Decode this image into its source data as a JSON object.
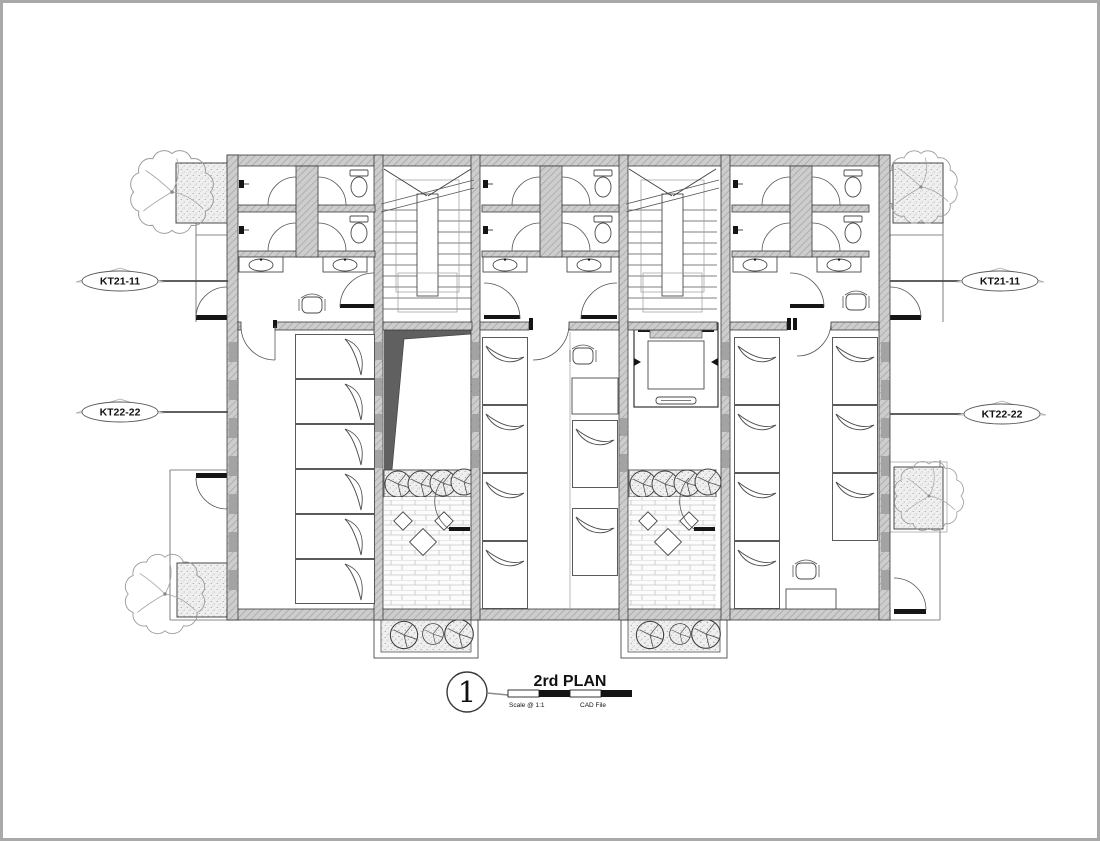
{
  "title_block": {
    "detail_number": "1",
    "title": "2rd PLAN",
    "scale_text": "Scale @ 1:1",
    "file_text": "CAD File"
  },
  "section_markers": {
    "left_top": "KT21-11",
    "left_bottom": "KT22-22",
    "right_top": "KT21-11",
    "right_bottom": "KT22-22"
  },
  "colors": {
    "wall_fill": "#cdcdcd",
    "wall_hatch": "#a0a0a0",
    "line_dark": "#2e2e2e",
    "shadow_gray": "#606060",
    "frame_border": "#a9a9a9"
  }
}
